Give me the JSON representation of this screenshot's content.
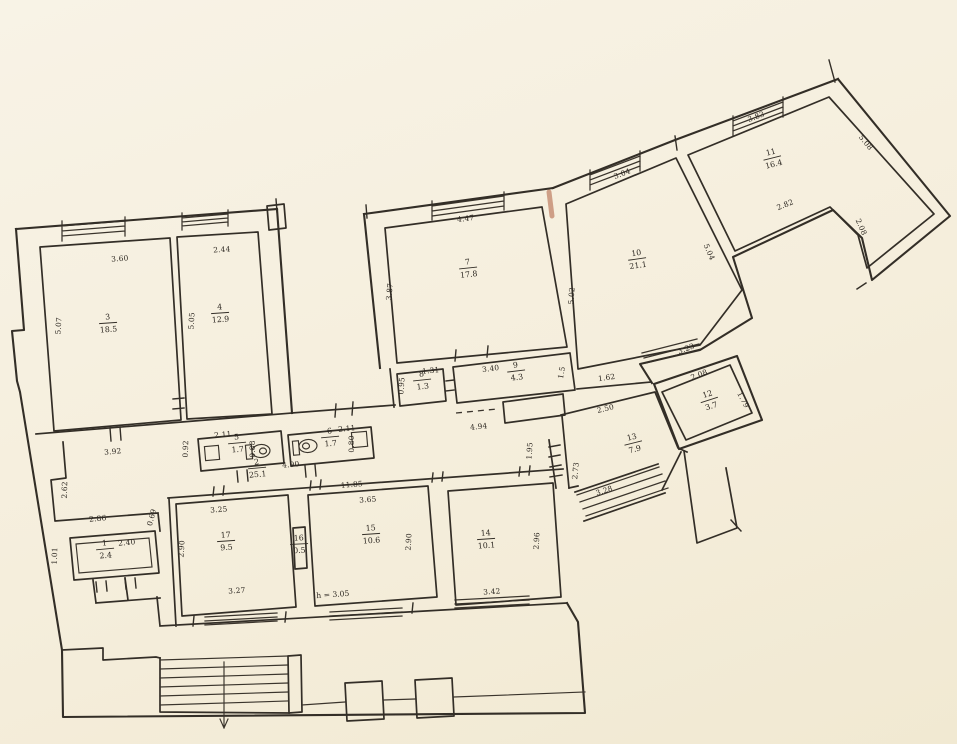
{
  "canvas": {
    "width": 957,
    "height": 744
  },
  "colors": {
    "paper": "#f6f0e0",
    "ink": "#332e27",
    "pen_mark": "#a8502f"
  },
  "note": {
    "text": "h = 3.05",
    "x": 333,
    "y": 597,
    "rot": -4
  },
  "rooms": [
    {
      "number": "1",
      "area": "2.4",
      "x": 105,
      "y": 548,
      "rot": -5
    },
    {
      "number": "2",
      "area": "25.1",
      "x": 257,
      "y": 467,
      "rot": -5
    },
    {
      "number": "3",
      "area": "18.5",
      "x": 108,
      "y": 322,
      "rot": -4
    },
    {
      "number": "4",
      "area": "12.9",
      "x": 220,
      "y": 312,
      "rot": -4
    },
    {
      "number": "5",
      "area": "1.7",
      "x": 237,
      "y": 442,
      "rot": -5
    },
    {
      "number": "6",
      "area": "1.7",
      "x": 330,
      "y": 436,
      "rot": -5
    },
    {
      "number": "7",
      "area": "17.8",
      "x": 468,
      "y": 267,
      "rot": -6
    },
    {
      "number": "8",
      "area": "1.3",
      "x": 422,
      "y": 379,
      "rot": -6
    },
    {
      "number": "9",
      "area": "4.3",
      "x": 516,
      "y": 370,
      "rot": -7
    },
    {
      "number": "10",
      "area": "21.1",
      "x": 637,
      "y": 258,
      "rot": -8
    },
    {
      "number": "11",
      "area": "16.4",
      "x": 772,
      "y": 157,
      "rot": -14
    },
    {
      "number": "12",
      "area": "3.7",
      "x": 709,
      "y": 399,
      "rot": -18
    },
    {
      "number": "13",
      "area": "7.9",
      "x": 633,
      "y": 442,
      "rot": -14
    },
    {
      "number": "14",
      "area": "10.1",
      "x": 486,
      "y": 538,
      "rot": -4
    },
    {
      "number": "15",
      "area": "10.6",
      "x": 371,
      "y": 533,
      "rot": -4
    },
    {
      "number": "16",
      "area": "0.5",
      "x": 299,
      "y": 543,
      "rot": -3
    },
    {
      "number": "17",
      "area": "9.5",
      "x": 226,
      "y": 540,
      "rot": -4
    }
  ],
  "dimensions": [
    {
      "text": "3.60",
      "x": 120,
      "y": 261,
      "rot": -4
    },
    {
      "text": "2.44",
      "x": 222,
      "y": 252,
      "rot": -3
    },
    {
      "text": "5.07",
      "x": 61,
      "y": 326,
      "rot": -86
    },
    {
      "text": "5.05",
      "x": 194,
      "y": 321,
      "rot": -87
    },
    {
      "text": "4.47",
      "x": 466,
      "y": 221,
      "rot": -7
    },
    {
      "text": "3.87",
      "x": 392,
      "y": 292,
      "rot": -84
    },
    {
      "text": "3.04",
      "x": 623,
      "y": 176,
      "rot": -21
    },
    {
      "text": "3.83",
      "x": 757,
      "y": 119,
      "rot": -21
    },
    {
      "text": "5.08",
      "x": 864,
      "y": 144,
      "rot": 51
    },
    {
      "text": "2.82",
      "x": 786,
      "y": 207,
      "rot": -22
    },
    {
      "text": "2.08",
      "x": 859,
      "y": 228,
      "rot": 66
    },
    {
      "text": "5.02",
      "x": 574,
      "y": 296,
      "rot": -86
    },
    {
      "text": "5.04",
      "x": 707,
      "y": 253,
      "rot": 66
    },
    {
      "text": "3.23",
      "x": 687,
      "y": 351,
      "rot": -21
    },
    {
      "text": "1.62",
      "x": 607,
      "y": 380,
      "rot": -8
    },
    {
      "text": "2.08",
      "x": 700,
      "y": 377,
      "rot": -21
    },
    {
      "text": "1.79",
      "x": 741,
      "y": 401,
      "rot": 62
    },
    {
      "text": "2.50",
      "x": 606,
      "y": 411,
      "rot": -13
    },
    {
      "text": "1.95",
      "x": 532,
      "y": 451,
      "rot": -87
    },
    {
      "text": "2.73",
      "x": 578,
      "y": 471,
      "rot": -84
    },
    {
      "text": "3.28",
      "x": 605,
      "y": 493,
      "rot": -18
    },
    {
      "text": "4.94",
      "x": 479,
      "y": 429,
      "rot": -6
    },
    {
      "text": "11.85",
      "x": 352,
      "y": 487,
      "rot": -5
    },
    {
      "text": "4.90",
      "x": 291,
      "y": 467,
      "rot": -5
    },
    {
      "text": "2.11",
      "x": 223,
      "y": 437,
      "rot": -5
    },
    {
      "text": "2.11",
      "x": 347,
      "y": 431,
      "rot": -5
    },
    {
      "text": "0.88",
      "x": 255,
      "y": 449,
      "rot": -90
    },
    {
      "text": "0.80",
      "x": 354,
      "y": 444,
      "rot": -90
    },
    {
      "text": "0.92",
      "x": 188,
      "y": 449,
      "rot": -88
    },
    {
      "text": "3.92",
      "x": 113,
      "y": 454,
      "rot": -5
    },
    {
      "text": "2.62",
      "x": 67,
      "y": 490,
      "rot": -88
    },
    {
      "text": "2.86",
      "x": 98,
      "y": 521,
      "rot": -5
    },
    {
      "text": "2.40",
      "x": 127,
      "y": 545,
      "rot": -5
    },
    {
      "text": "1.01",
      "x": 57,
      "y": 556,
      "rot": -88
    },
    {
      "text": "0.69",
      "x": 154,
      "y": 518,
      "rot": -75
    },
    {
      "text": "3.40",
      "x": 491,
      "y": 371,
      "rot": -7
    },
    {
      "text": "1.31",
      "x": 431,
      "y": 373,
      "rot": -6
    },
    {
      "text": "0.95",
      "x": 404,
      "y": 386,
      "rot": -86
    },
    {
      "text": "1.5",
      "x": 564,
      "y": 373,
      "rot": -80
    },
    {
      "text": "3.25",
      "x": 219,
      "y": 512,
      "rot": -4
    },
    {
      "text": "2.90",
      "x": 184,
      "y": 549,
      "rot": -87
    },
    {
      "text": "3.27",
      "x": 237,
      "y": 593,
      "rot": -4
    },
    {
      "text": "3.65",
      "x": 368,
      "y": 502,
      "rot": -4
    },
    {
      "text": "2.90",
      "x": 411,
      "y": 542,
      "rot": -87
    },
    {
      "text": "3.42",
      "x": 492,
      "y": 594,
      "rot": -4
    },
    {
      "text": "2.96",
      "x": 539,
      "y": 541,
      "rot": -87
    }
  ]
}
